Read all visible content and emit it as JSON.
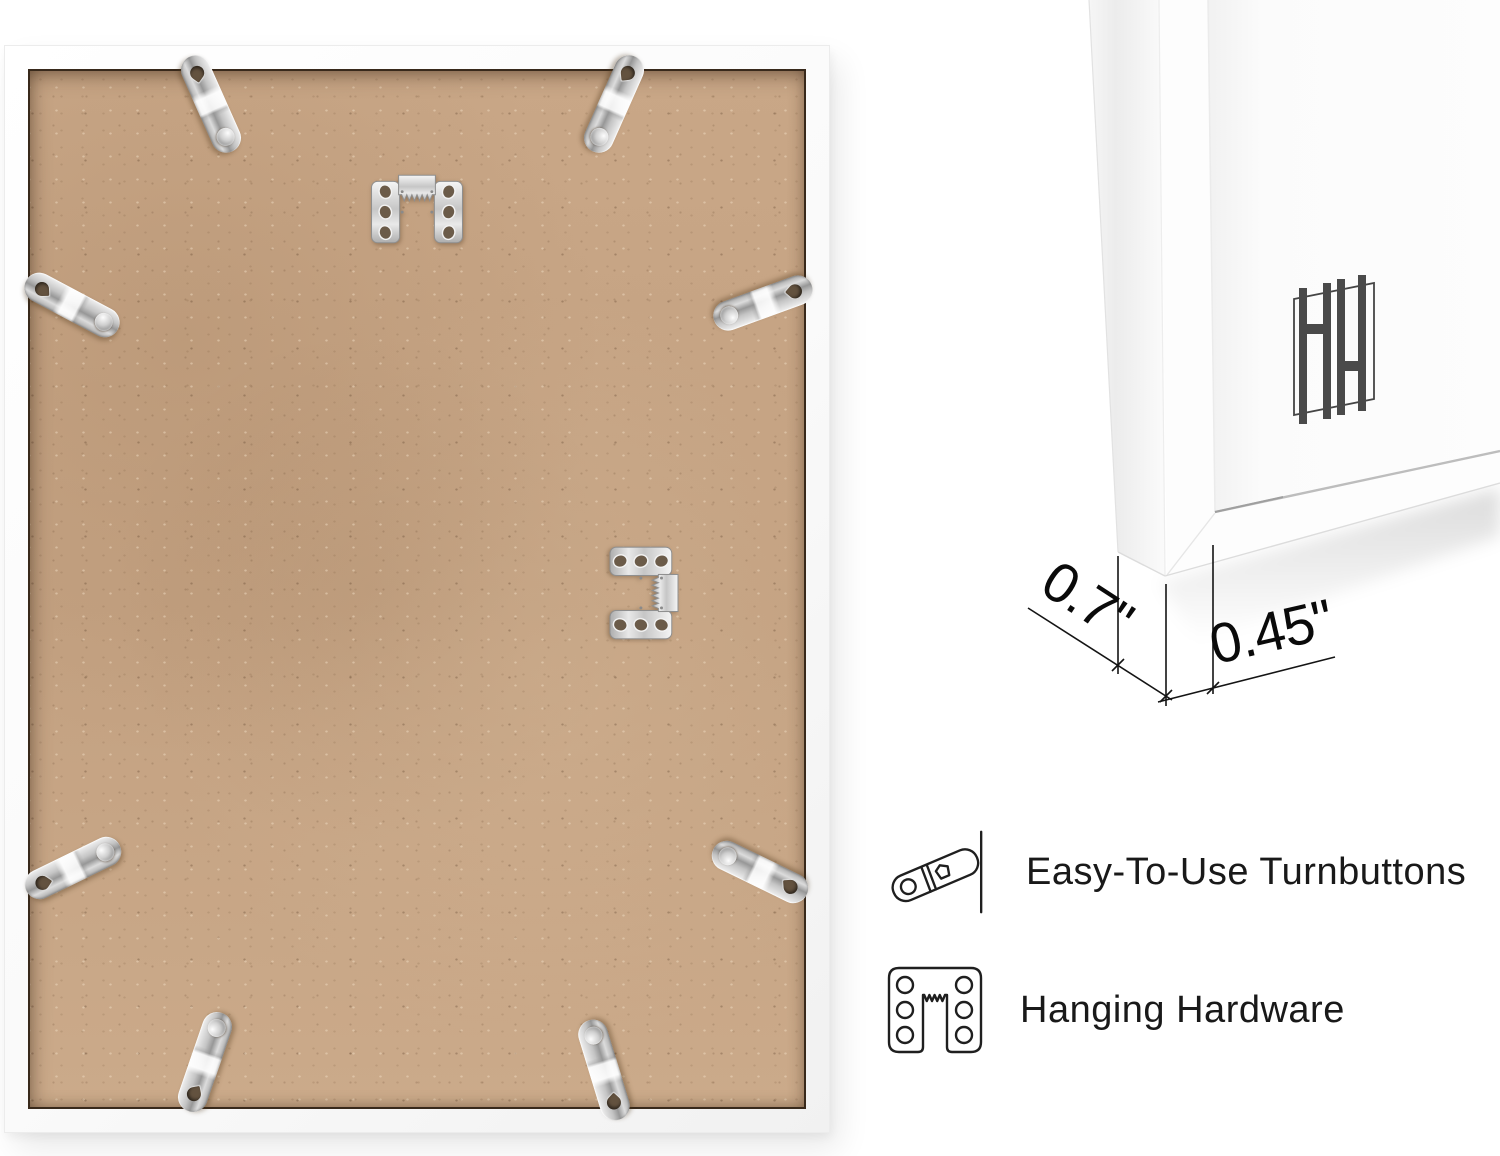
{
  "canvas": {
    "width": 1500,
    "height": 1156,
    "background": "#ffffff"
  },
  "photo": {
    "subject": "frame-back-with-hardware",
    "mdf_color": "#c7a585",
    "seam_color": "#38291b",
    "frame_color": "#fbfbfb",
    "metal_color": "#cccccc",
    "turnbutton_count": 8,
    "sawtooth_hanger_count": 2
  },
  "closeup": {
    "subject": "frame-corner-profile",
    "logo_icon": "hh-monogram",
    "logo_color": "#4a4a4a",
    "frame_color": "#fdfdfd",
    "glass_edge_color": "#bdbdbd"
  },
  "dimensions": {
    "depth": "0.7\"",
    "face": "0.45\""
  },
  "features": [
    {
      "icon": "turnbutton-icon",
      "label": "Easy-To-Use Turnbuttons"
    },
    {
      "icon": "hanging-hardware-icon",
      "label": "Hanging Hardware"
    }
  ],
  "colors": {
    "line_art": "#1f1f1f",
    "dimension_text": "#0a0a0a",
    "label_text": "#191919"
  }
}
